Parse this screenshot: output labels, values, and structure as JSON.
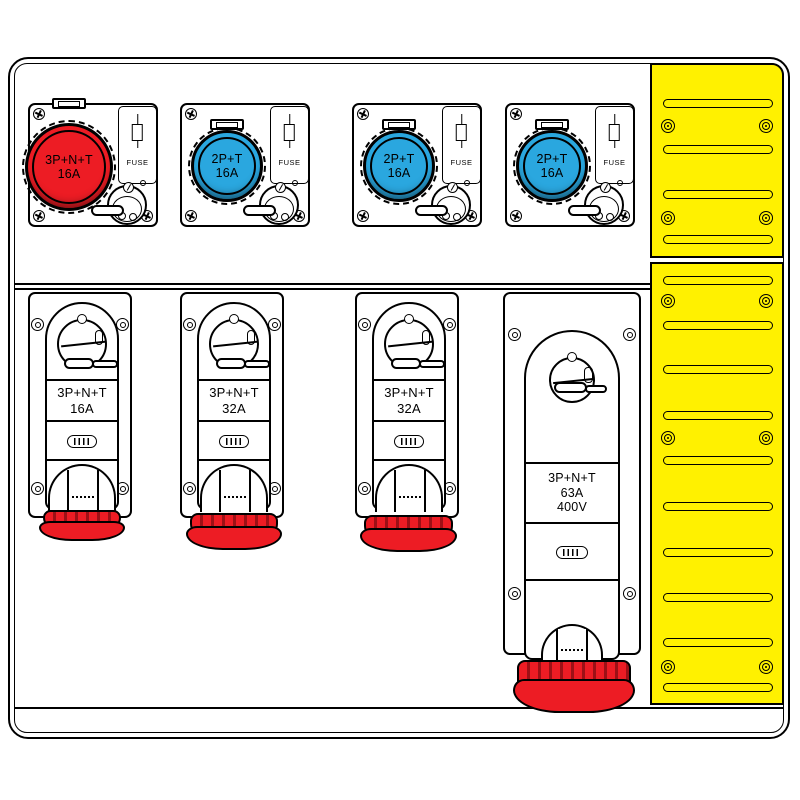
{
  "board": {
    "name": "industrial socket distribution board"
  },
  "colors": {
    "red": "#ed1c24",
    "blue": "#2aa7df",
    "yellow": "#fff100",
    "rib_red": "#9e1016",
    "outline": "#000000"
  },
  "icons": {
    "screw-cross-icon": "circle with cross slot (CSS shape)",
    "screw-ring-icon": "concentric ring screw (CSS shape)",
    "panel-screw-icon": "triple concentric ring (CSS shape)",
    "vent-slot-icon": "rounded horizontal slot (CSS shape)",
    "fuse-icon": "cartridge fuse symbol (CSS shape)",
    "vent-icon": "striped oval vent (CSS shape)",
    "latch-icon": "hinge clip (CSS shape)"
  },
  "top_units": [
    {
      "line1": "3P+N+T",
      "line2": "16A",
      "fuse": "FUSE",
      "color": "red"
    },
    {
      "line1": "2P+T",
      "line2": "16A",
      "fuse": "FUSE",
      "color": "blue"
    },
    {
      "line1": "2P+T",
      "line2": "16A",
      "fuse": "FUSE",
      "color": "blue"
    },
    {
      "line1": "2P+T",
      "line2": "16A",
      "fuse": "FUSE",
      "color": "blue"
    }
  ],
  "bottom_units": [
    {
      "line1": "3P+N+T",
      "line2": "16A",
      "line3": ""
    },
    {
      "line1": "3P+N+T",
      "line2": "32A",
      "line3": ""
    },
    {
      "line1": "3P+N+T",
      "line2": "32A",
      "line3": ""
    },
    {
      "line1": "3P+N+T",
      "line2": "63A",
      "line3": "400V"
    }
  ]
}
